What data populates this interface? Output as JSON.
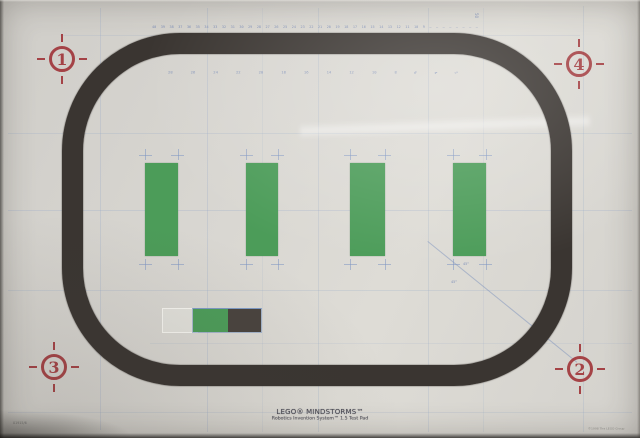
{
  "pad": {
    "markers": {
      "top_left": "1",
      "top_right": "4",
      "bottom_left": "3",
      "bottom_right": "2"
    },
    "footer_line1": "LEGO® MINDSTORMS™",
    "footer_line2": "Robotics Invention System™ 1.5 Test Pad",
    "side_code": "01915/6",
    "copyright": "©1998 The LEGO Group",
    "vertical_ruler_label": "50",
    "angle_labels": [
      "45°",
      "45°"
    ],
    "ruler_top": [
      "40",
      "39",
      "38",
      "37",
      "36",
      "35",
      "34",
      "33",
      "32",
      "31",
      "30",
      "29",
      "28",
      "27",
      "26",
      "25",
      "24",
      "23",
      "22",
      "21",
      "20",
      "19",
      "18",
      "17",
      "16",
      "15",
      "14",
      "13",
      "12",
      "11",
      "10",
      "9",
      "–",
      "–",
      "–",
      "–",
      "–",
      "–",
      "–",
      "–"
    ],
    "ruler_inner": [
      "28",
      "26",
      "24",
      "22",
      "20",
      "18",
      "16",
      "14",
      "12",
      "10",
      "8",
      "6",
      "4",
      "2"
    ],
    "colors": {
      "paper": "#d6d4cf",
      "track_black": "#3a3531",
      "bar_green": "#4c9c59",
      "cell_dark": "#49433e",
      "marker_red": "#a23a3e",
      "grid_blue": "#91a5c8",
      "ruler_blue": "#7286b5"
    }
  }
}
